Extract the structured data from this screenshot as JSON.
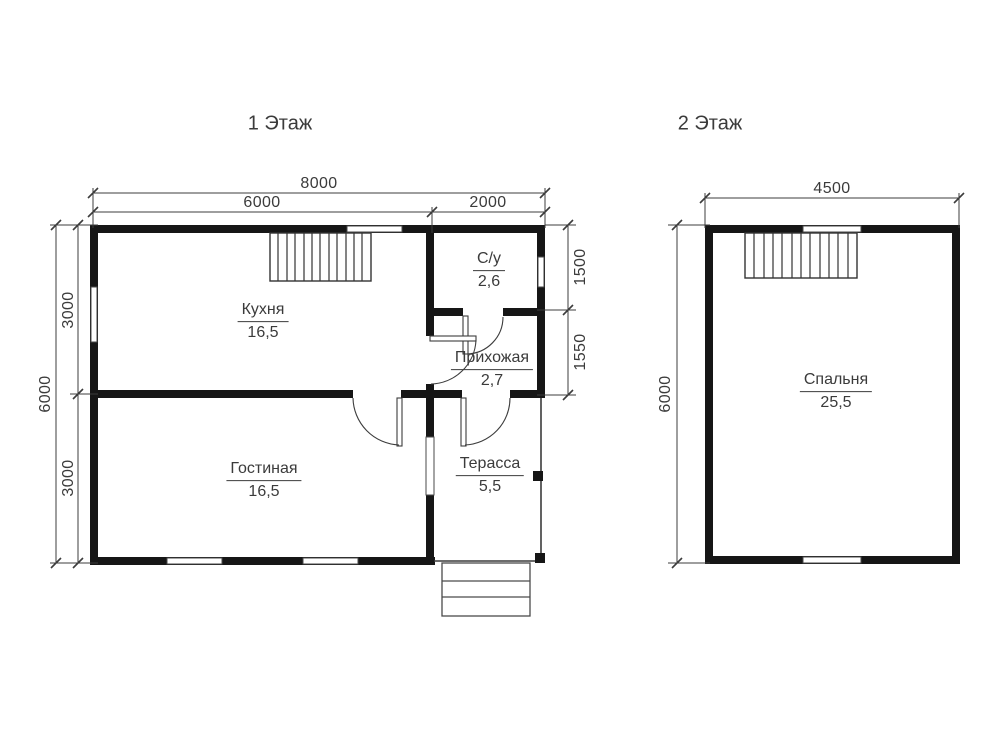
{
  "colors": {
    "background": "#ffffff",
    "wall": "#161616",
    "line": "#3c3c3c",
    "text": "#3b3b3b"
  },
  "floors": [
    {
      "title": "1 Этаж",
      "rooms": [
        {
          "name": "Кухня",
          "area": "16,5"
        },
        {
          "name": "С/у",
          "area": "2,6"
        },
        {
          "name": "Прихожая",
          "area": "2,7"
        },
        {
          "name": "Гостиная",
          "area": "16,5"
        },
        {
          "name": "Терасса",
          "area": "5,5"
        }
      ],
      "dimensions": {
        "total_width": "8000",
        "width_left": "6000",
        "width_right": "2000",
        "total_height": "6000",
        "height_upper": "3000",
        "height_lower": "3000",
        "right_upper": "1500",
        "right_lower": "1550"
      }
    },
    {
      "title": "2 Этаж",
      "rooms": [
        {
          "name": "Спальня",
          "area": "25,5"
        }
      ],
      "dimensions": {
        "total_width": "4500",
        "total_height": "6000"
      }
    }
  ]
}
